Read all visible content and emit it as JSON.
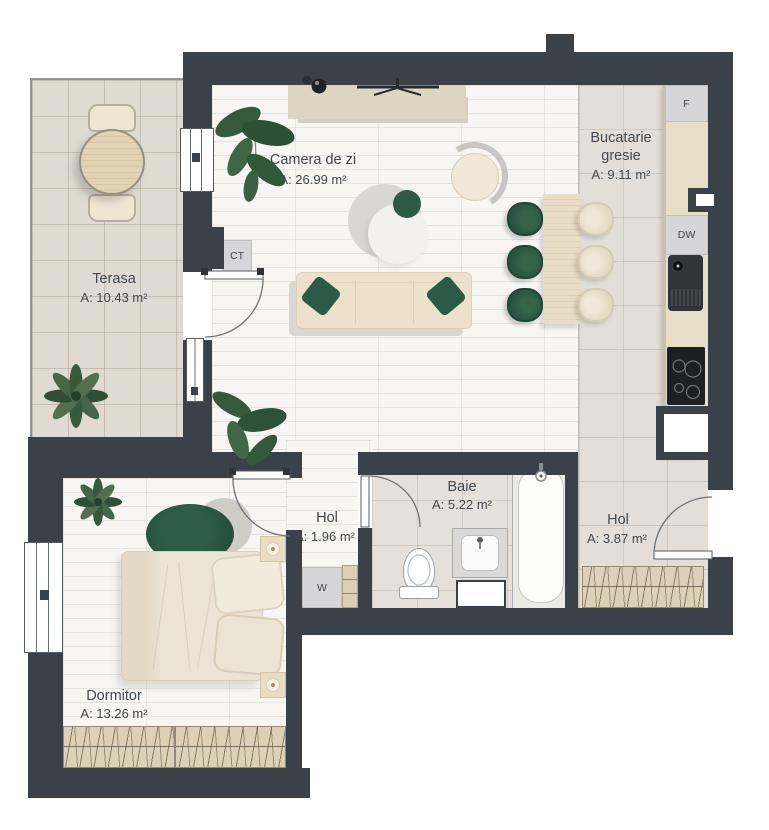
{
  "rooms": {
    "living": {
      "name": "Camera de zi",
      "area": "A: 26.99 m²"
    },
    "kitchen": {
      "line1": "Bucatarie",
      "line2": "gresie",
      "area": "A: 9.11 m²"
    },
    "terrace": {
      "name": "Terasa",
      "area": "A: 10.43 m²"
    },
    "bathroom": {
      "name": "Baie",
      "area": "A: 5.22 m²"
    },
    "hall_small": {
      "name": "Hol",
      "area": "A: 1.96 m²"
    },
    "hall_entry": {
      "name": "Hol",
      "area": "A: 3.87 m²"
    },
    "bedroom": {
      "name": "Dormitor",
      "area": "A: 13.26 m²"
    }
  },
  "appliances": {
    "fridge": "F",
    "dishwasher": "DW",
    "boiler": "CT",
    "washer": "W"
  },
  "colors": {
    "wall": "#3a4149",
    "accent_green": "#2c5b45",
    "furniture_beige": "#ecdfc9",
    "tile": "#dfdbd3",
    "wood_floor": "#f7f6f3"
  }
}
